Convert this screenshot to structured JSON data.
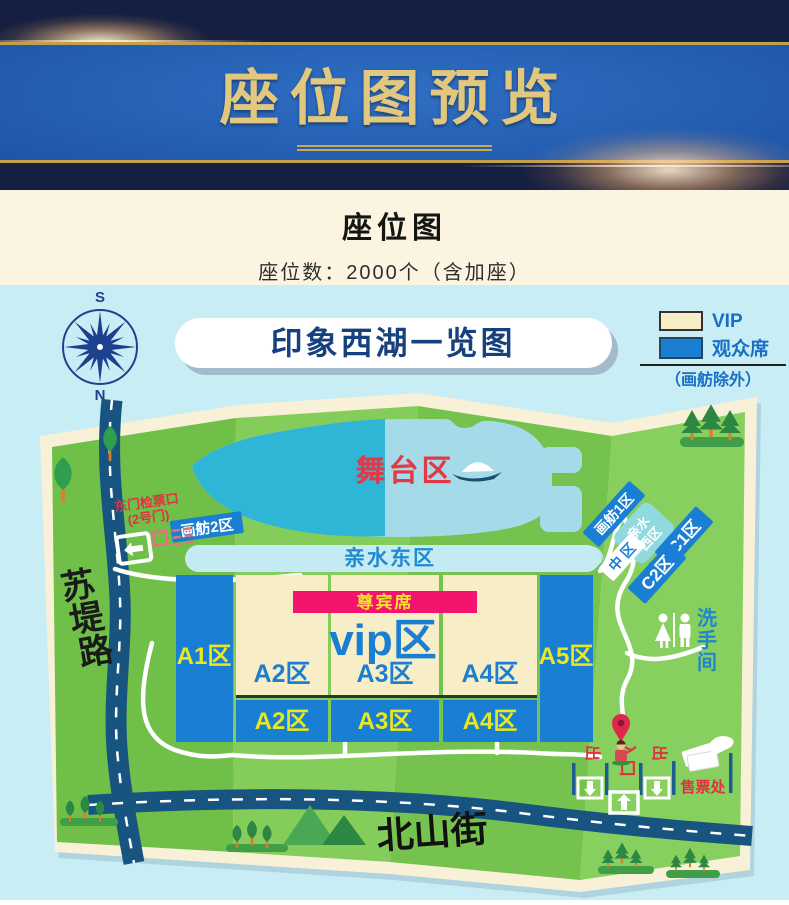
{
  "header": {
    "title": "座位图预览"
  },
  "info": {
    "title": "座位图",
    "seat_count": "座位数：2000个（含加座）"
  },
  "map": {
    "banner_title": "印象西湖一览图",
    "compass": {
      "south": "S",
      "north": "N"
    },
    "legend": {
      "vip_label": "VIP",
      "vip_color": "#f7edc6",
      "audience_label": "观众席",
      "audience_color": "#1a7fd2",
      "note": "（画舫除外）"
    },
    "stage": {
      "label": "舞台区"
    },
    "east_gate": {
      "line1": "东门检票口",
      "line2": "(2号门)"
    },
    "zones": {
      "huafang2": "画舫2区",
      "huafang1": "画舫1区",
      "qinshui_west_line1": "亲水",
      "qinshui_west_line2": "西区",
      "zhongqu": "中 区",
      "c1": "C1区",
      "c2": "C2区",
      "qinshui_east": "亲水东区",
      "zunbin": "尊宾席",
      "vip": "vip区",
      "a1": "A1区",
      "a2": "A2区",
      "a3": "A3区",
      "a4": "A4区",
      "a5": "A5区"
    },
    "roads": {
      "sudi_1": "苏",
      "sudi_2": "堤",
      "sudi_3": "路",
      "beishan": "北山街"
    },
    "facilities": {
      "restroom_1": "洗",
      "restroom_2": "手",
      "restroom_3": "间",
      "exit_left": "出",
      "exit_right": "出",
      "entrance": "入口",
      "ticket_office": "售票处"
    },
    "colors": {
      "zone_blue": "#1a7fd2",
      "zone_cream": "#f7edc6",
      "vip_banner_pink": "#f4146e",
      "lake_teal": "#2fb6d6",
      "lake_pale": "#a5dbe9",
      "road_navy": "#17547f",
      "label_yellow": "#e8e822",
      "red": "#e0333f"
    }
  }
}
